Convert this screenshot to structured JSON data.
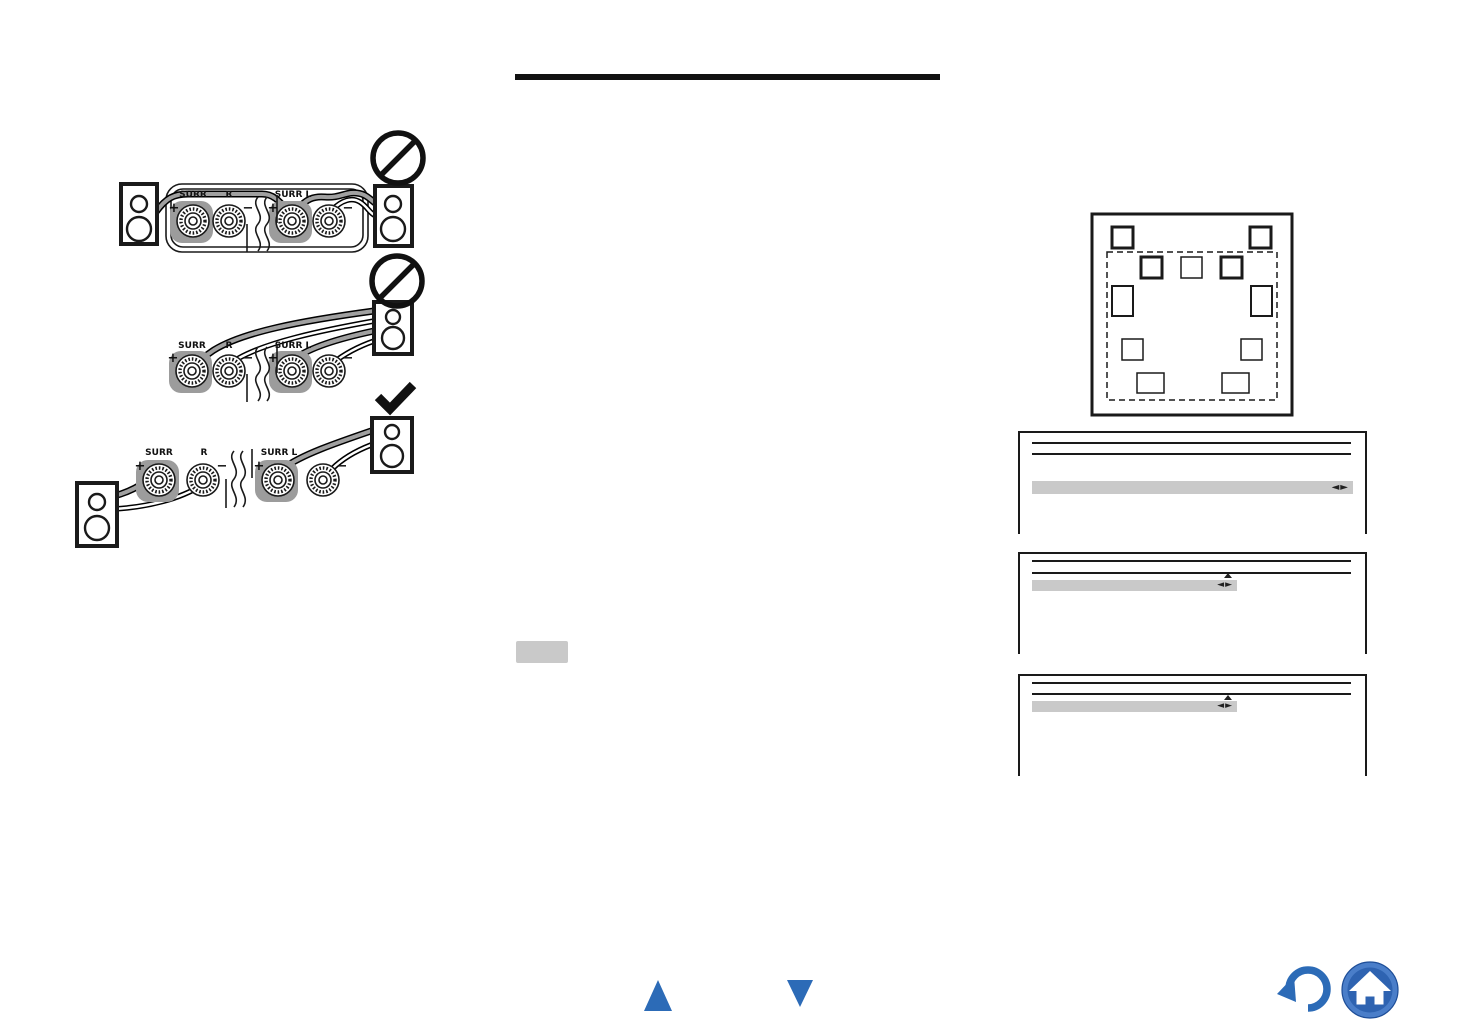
{
  "page": {
    "background": "#ffffff"
  },
  "colors": {
    "ink": "#1a1a1a",
    "accent_blue": "#2c6bb7",
    "home_outer_blue": "#4a7ec9",
    "home_inner_blue": "#2e63b1",
    "terminal_highlight_gray": "#9c9c9c",
    "osd_bar_gray": "#c9c9c9",
    "wire_gray": "#a0a0a0"
  },
  "wiring_diagrams": {
    "terminal_labels": {
      "surr": "SURR",
      "r": "R",
      "surr_l": "SURR L"
    },
    "polarity": {
      "plus": "+",
      "minus": "−"
    },
    "examples": [
      {
        "name": "wrong-connection-1",
        "verdict_icon": "prohibited-icon"
      },
      {
        "name": "wrong-connection-2",
        "verdict_icon": "prohibited-icon"
      },
      {
        "name": "correct-connection",
        "verdict_icon": "check-icon"
      }
    ]
  },
  "speaker_layout": {
    "speaker_boxes": 11,
    "listening_area": "dashed-rectangle"
  },
  "osd_screens": [
    {
      "selector_arrows": "◄►",
      "up_indicator": false
    },
    {
      "selector_arrows": "◄►",
      "up_indicator": true
    },
    {
      "selector_arrows": "◄►",
      "up_indicator": true
    }
  ],
  "icons": {
    "prohibited-icon": "circle-with-slash",
    "check-icon": "bold-checkmark",
    "page-up-icon": "blue-up-triangle",
    "page-down-icon": "blue-down-triangle",
    "return-icon": "blue-curved-back-arrow",
    "home-icon": "white-house-in-blue-circle"
  }
}
